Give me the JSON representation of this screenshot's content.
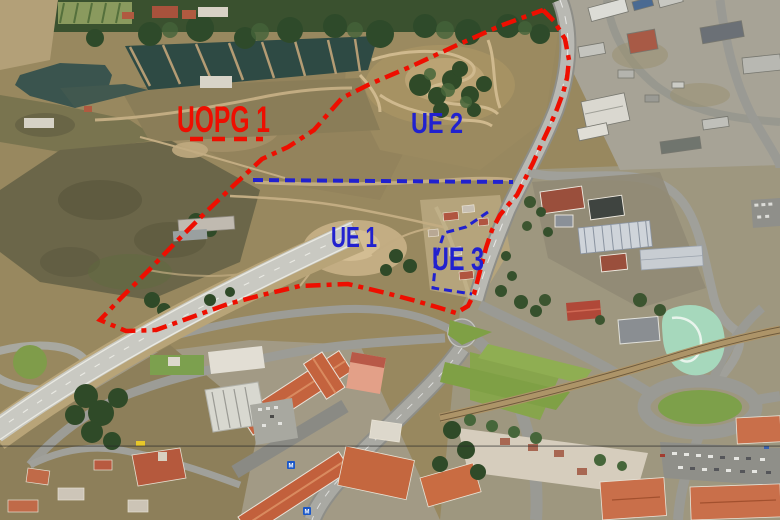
{
  "annotations": {
    "red_color": "#ee0e00",
    "blue_color": "#2121cf",
    "labels": {
      "uopg1": "UOPG 1",
      "ue2": "UE 2",
      "ue1": "UE 1",
      "ue3": "UE 3"
    },
    "red_boundary_points": "543,10 554,21 565,39 569,60 567,78 563,93 557,109 549,128 541,145 533,163 525,179 517,195 509,204 500,215 492,230 486,248 480,271 474,294 468,306 456,313 440,308 416,301 386,293 348,284 300,286 262,295 228,304 192,317 156,330 126,331 100,320 122,297 148,271 177,241 205,213 233,186 262,159 288,147 314,130 342,98 370,84 412,66 455,46 500,26 543,10",
    "uopg1_underline_points": "190,139 263,139",
    "blue_divider_points": "253,180 380,181 513,182",
    "ue3_outline_points": "488,212 466,227 444,233 436,258 433,288 472,294"
  }
}
